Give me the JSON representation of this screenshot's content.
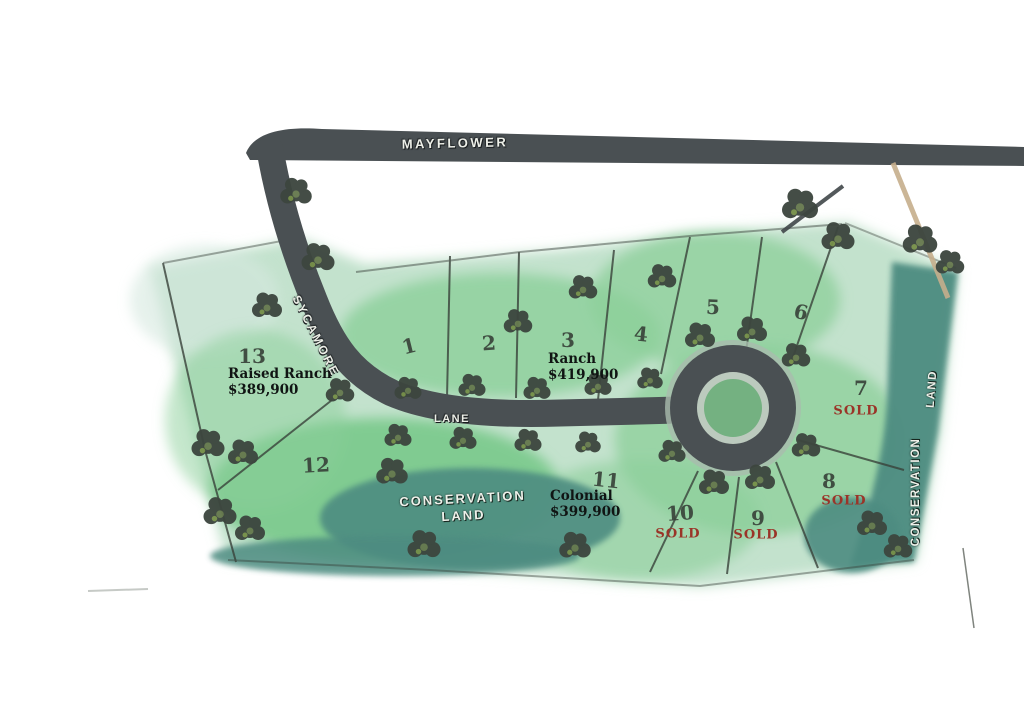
{
  "roads": {
    "mayflower": "MAYFLOWER",
    "sycamore": "SYCAMORE",
    "lane": "LANE"
  },
  "conservation": {
    "center_line1": "CONSERVATION",
    "center_line2": "LAND",
    "right_line1": "CONSERVATION",
    "right_line2": "LAND"
  },
  "labels": {
    "sold_text": "SOLD"
  },
  "colors": {
    "road_gray": "#4a5053",
    "conservation_teal": "#4e8c81",
    "parcel_green": "#8ccf9a",
    "tree_green": "#3d463f",
    "sold_red": "#9a3428"
  },
  "lots": [
    {
      "number": "1",
      "x": 409,
      "y": 346,
      "rot": -14
    },
    {
      "number": "2",
      "x": 489,
      "y": 343,
      "rot": -4
    },
    {
      "number": "3",
      "x": 568,
      "y": 340,
      "rot": 0,
      "type": "Ranch",
      "price": "$419,900",
      "tx": 548,
      "ty": 351
    },
    {
      "number": "4",
      "x": 641,
      "y": 334,
      "rot": 6
    },
    {
      "number": "5",
      "x": 713,
      "y": 307,
      "rot": 2
    },
    {
      "number": "6",
      "x": 801,
      "y": 312,
      "rot": 12
    },
    {
      "number": "7",
      "x": 861,
      "y": 388,
      "rot": 0,
      "sold": true,
      "sx": 856,
      "sy": 411
    },
    {
      "number": "8",
      "x": 829,
      "y": 481,
      "rot": 0,
      "sold": true,
      "sx": 844,
      "sy": 501
    },
    {
      "number": "9",
      "x": 758,
      "y": 518,
      "rot": 0,
      "sold": true,
      "sx": 756,
      "sy": 535
    },
    {
      "number": "10",
      "x": 680,
      "y": 513,
      "rot": -4,
      "sold": true,
      "sx": 678,
      "sy": 534
    },
    {
      "number": "11",
      "x": 606,
      "y": 480,
      "rot": 6,
      "type": "Colonial",
      "price": "$399,900",
      "tx": 550,
      "ty": 488
    },
    {
      "number": "12",
      "x": 316,
      "y": 465,
      "rot": -3
    },
    {
      "number": "13",
      "x": 252,
      "y": 356,
      "rot": 0,
      "type": "Raised Ranch",
      "price": "$389,900",
      "tx": 228,
      "ty": 366
    }
  ]
}
